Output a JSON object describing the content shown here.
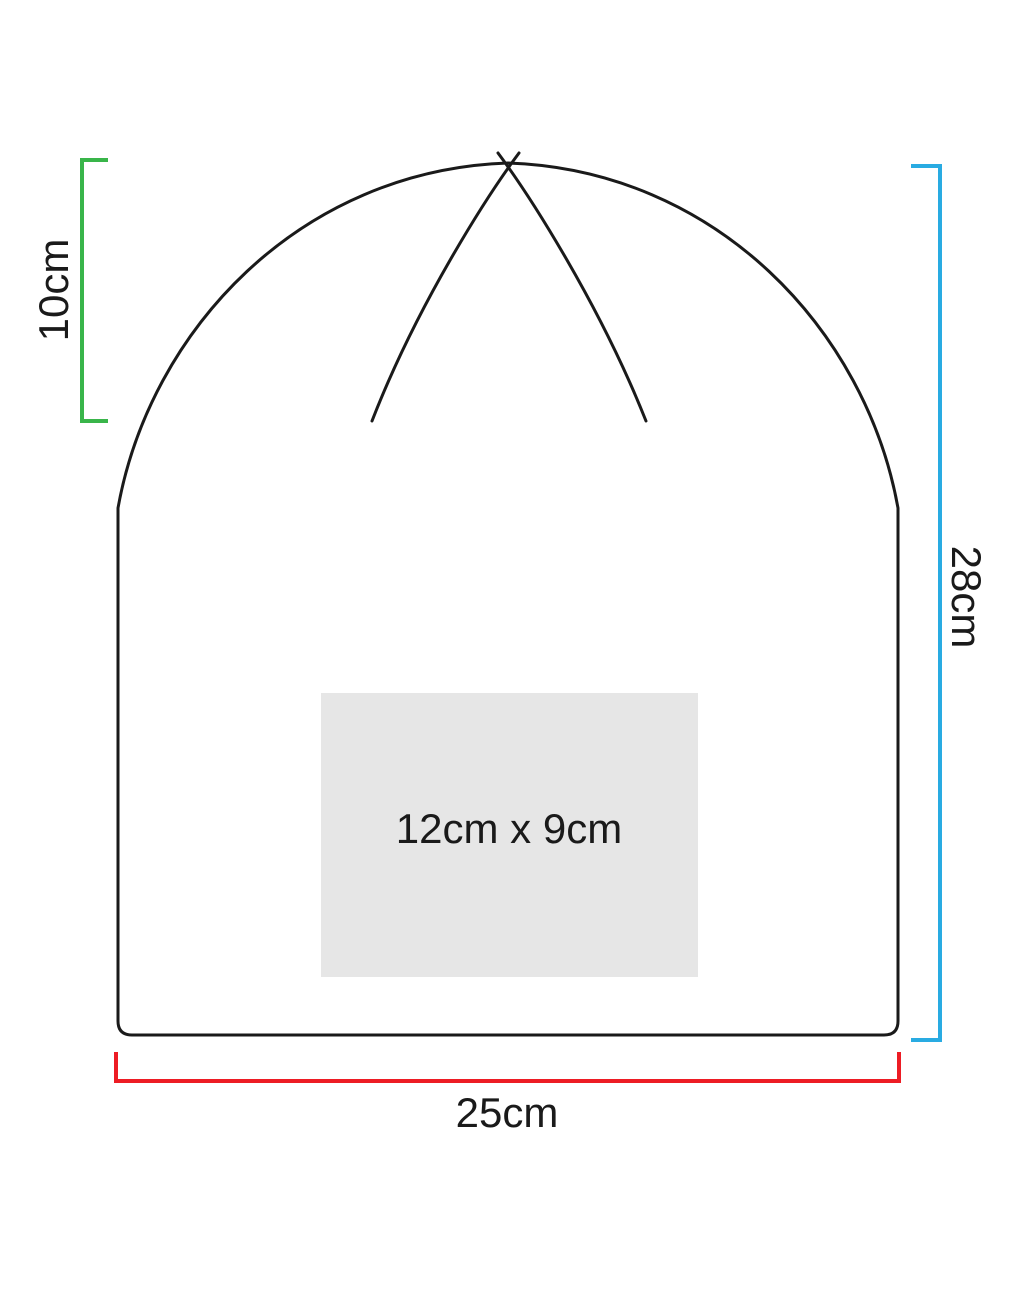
{
  "measurements": {
    "crown_height": {
      "label": "10cm",
      "color": "#39b54a"
    },
    "total_height": {
      "label": "28cm",
      "color": "#29abe2"
    },
    "brim_width": {
      "label": "25cm",
      "color": "#ed1c24"
    }
  },
  "print_area": {
    "label": "12cm x 9cm",
    "fill": "#e6e6e6"
  },
  "outline_color": "#1a1a1a",
  "background": "#ffffff"
}
